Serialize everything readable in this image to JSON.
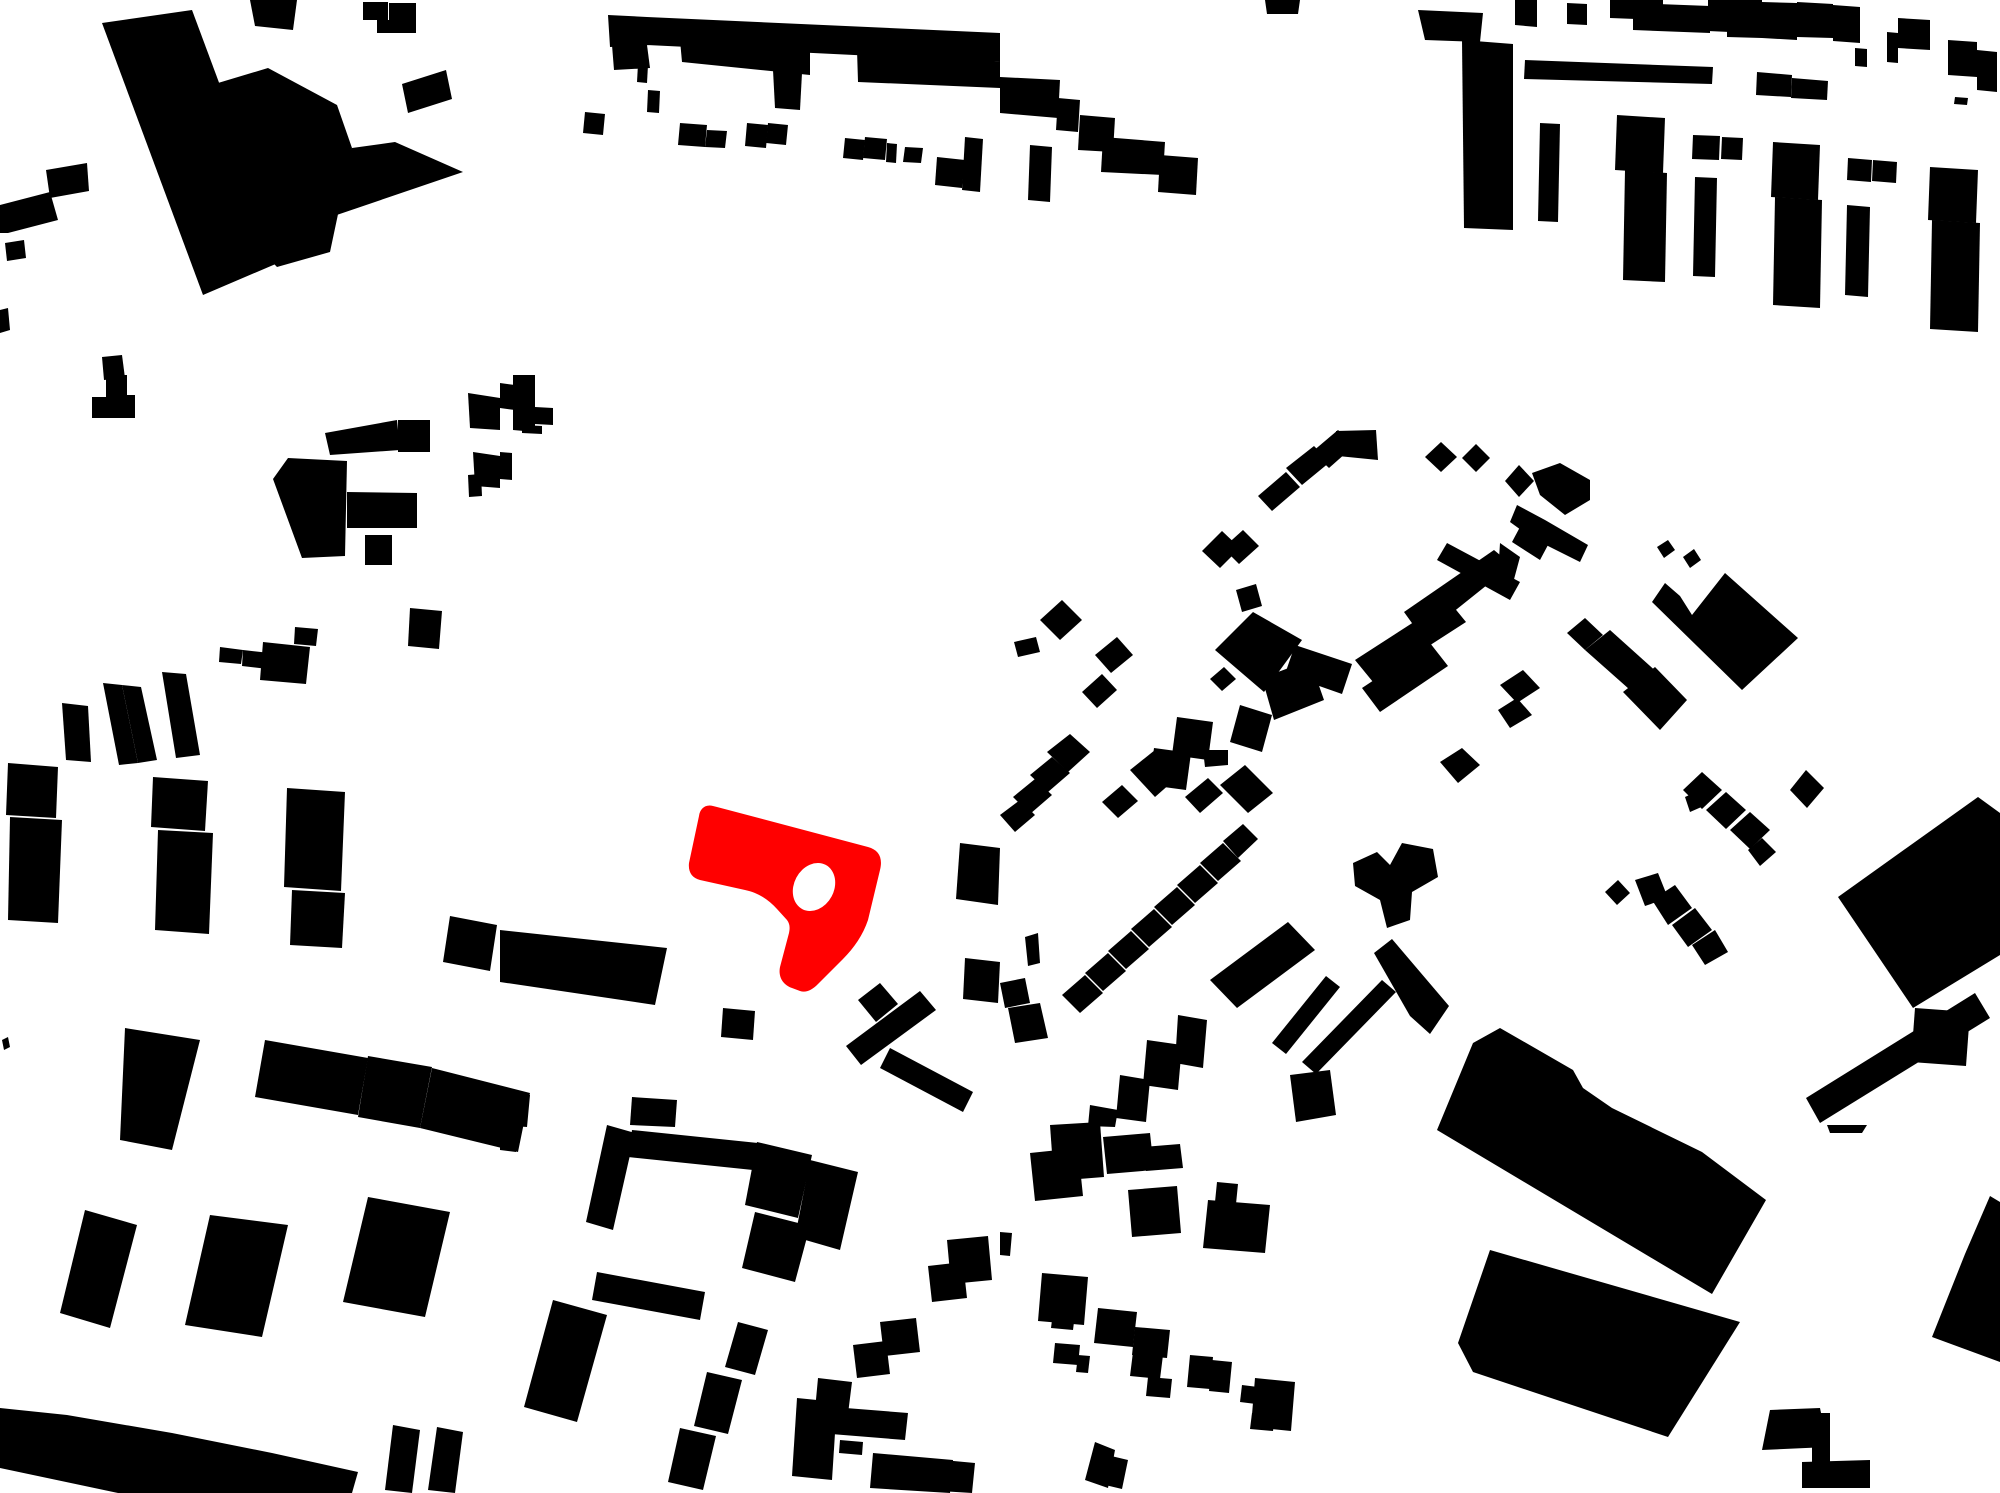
{
  "map": {
    "type": "figure-ground-site-plan",
    "canvas": {
      "width": 2000,
      "height": 1493,
      "viewBox": "0 0 2000 1493"
    },
    "colors": {
      "background": "#ffffff",
      "building": "#000000",
      "highlight": "#ff0000",
      "courtyard": "#ffffff"
    },
    "highlight": {
      "path": "M 713,806 C 705,804 700,809 699,816 L 689,863 C 688,872 692,878 700,880 L 745,890 C 759,893 769,900 777,909 L 787,920 C 790,924 790,928 789,933 L 780,967 C 778,977 783,985 792,988 L 800,991 C 806,993 812,990 818,984 L 843,959 C 854,948 863,935 868,920 L 880,870 C 883,858 879,850 868,847 L 717,807 Z",
      "courtyard_hole": {
        "cx": 814,
        "cy": 887,
        "rx": 20,
        "ry": 25,
        "rotation": 28
      }
    },
    "buildings": [
      "102,23 192,10 285,260 203,295",
      "218,83 268,68 337,105 352,148 330,252 277,267 232,220",
      "352,148 395,142 463,172 322,220",
      "250,0 297,0 293,30 255,26",
      "363,2 388,2 388,20 363,20",
      "389,3 416,3 416,33 389,33",
      "377,20 390,20 390,33 377,33",
      "402,84 446,70 452,99 408,113",
      "46,170 87,163 89,191 50,198",
      "0,205 50,192 58,220 8,233 0,233",
      "5,243 24,240 26,258 7,261",
      "0,310 8,308 10,330 0,333",
      "102,357 122,355 125,378 104,380",
      "608,15 647,17 650,45 610,47",
      "647,17 1000,33 1000,62 647,45",
      "612,45 647,45 650,68 614,70",
      "680,40 810,48 810,75 682,62",
      "857,50 1000,62 1000,88 858,82",
      "773,70 802,73 800,110 775,108",
      "638,64 648,65 647,83 637,82",
      "1000,77 1060,80 1058,118 1000,113",
      "1058,98 1080,100 1078,132 1056,130",
      "1080,115 1115,118 1113,152 1078,150",
      "1103,137 1165,142 1163,175 1101,172",
      "1160,155 1198,158 1196,195 1158,192",
      "1030,145 1052,147 1050,202 1028,200",
      "585,112 605,114 603,135 583,133",
      "648,90 660,91 659,113 647,112",
      "680,123 707,125 705,147 678,145",
      "707,130 727,131 725,148 705,147",
      "747,123 768,125 766,148 745,146",
      "768,123 788,125 786,145 766,143",
      "845,138 865,140 863,160 843,158",
      "865,137 887,139 885,160 863,158",
      "887,143 897,144 896,163 886,162",
      "905,147 923,148 921,163 903,162",
      "937,157 965,160 962,188 935,185",
      "965,137 983,139 980,192 962,190",
      "1265,0 1300,0 1298,14 1267,14",
      "1418,10 1483,13 1480,42 1425,40",
      "1462,40 1513,44 1513,230 1464,228",
      "1515,0 1537,0 1537,27 1515,25",
      "1567,3 1587,4 1587,25 1567,24",
      "1610,0 1663,0 1663,20 1610,18",
      "1633,3 1710,6 1710,33 1633,30",
      "1708,0 1730,0 1730,32 1708,31",
      "1727,0 1762,0 1762,38 1727,37",
      "1762,2 1797,3 1797,40 1762,38",
      "1797,2 1833,4 1833,38 1797,37",
      "1833,5 1860,7 1860,43 1833,41",
      "1887,32 1898,33 1898,63 1887,62",
      "1898,18 1930,20 1930,50 1898,48",
      "1948,40 1977,42 1977,77 1948,75",
      "1977,50 1997,52 1997,92 1977,90",
      "1855,48 1867,49 1867,67 1855,66",
      "1525,60 1713,67 1712,84 1524,79",
      "1757,72 1792,75 1791,97 1756,95",
      "1792,78 1828,81 1827,100 1791,98",
      "1955,97 1968,98 1967,105 1954,104",
      "1540,123 1560,124 1558,222 1538,221",
      "1617,115 1665,118 1663,173 1615,170",
      "1625,170 1667,173 1665,282 1623,280",
      "1693,135 1720,136 1719,160 1692,159",
      "1722,137 1743,138 1742,160 1721,159",
      "1695,177 1717,178 1715,277 1693,276",
      "1773,142 1820,145 1818,200 1771,197",
      "1775,197 1822,200 1820,308 1773,305",
      "1848,158 1872,160 1871,182 1847,180",
      "1873,160 1897,162 1896,183 1872,181",
      "1847,205 1870,207 1868,297 1845,295",
      "1930,167 1978,170 1976,223 1928,220",
      "1932,220 1980,223 1978,332 1930,329",
      "106,375 127,375 127,395 135,395 135,418 92,418 92,397 106,397",
      "325,433 397,420 400,450 330,455",
      "398,420 430,420 430,452 398,452",
      "288,458 347,461 345,556 302,558 273,479",
      "347,492 417,493 417,528 347,528",
      "365,535 392,535 392,565 365,565",
      "468,393 500,398 500,430 470,428",
      "473,452 500,456 500,488 475,486",
      "468,475 481,474 482,496 469,497",
      "220,647 243,650 241,664 219,662",
      "243,650 270,653 268,669 242,666",
      "263,642 310,647 306,684 260,680",
      "295,627 318,629 316,646 294,644",
      "410,608 442,611 439,649 408,646",
      "62,703 88,706 91,762 66,760",
      "103,683 122,685 138,763 119,765",
      "122,685 141,687 157,760 138,763",
      "162,672 186,674 200,755 176,758",
      "513,375 535,375 535,432 513,430",
      "500,383 515,385 515,410 500,408",
      "535,407 553,408 553,425 535,424",
      "522,425 542,426 542,434 522,433",
      "500,452 512,453 512,480 500,479",
      "1258,496 1286,472 1300,487 1272,511",
      "1286,468 1314,446 1330,462 1302,485",
      "1312,452 1338,430 1355,445 1329,468",
      "1336,431 1376,430 1378,460 1338,456",
      "1441,442 1457,457 1441,472 1425,457",
      "1476,444 1490,458 1476,472 1462,458",
      "1202,551 1222,531 1240,548 1220,568",
      "1223,548 1243,530 1259,546 1239,564",
      "1236,590 1256,584 1262,606 1242,612",
      "1215,650 1253,612 1302,640 1264,692",
      "1295,645 1352,664 1342,694 1285,674",
      "1262,678 1310,660 1324,700 1274,720",
      "1210,679 1224,667 1236,679 1222,691",
      "1240,705 1272,715 1262,752 1230,742",
      "1177,717 1213,722 1208,760 1172,755",
      "1154,748 1191,753 1186,790 1149,785",
      "1047,752 1070,734 1090,752 1068,772",
      "1030,775 1052,757 1070,773 1048,792",
      "1013,797 1035,779 1052,795 1030,814",
      "1000,815 1020,800 1035,815 1015,832",
      "1102,802 1122,785 1138,801 1118,818",
      "1130,770 1155,750 1180,775 1155,797",
      "1185,797 1208,778 1223,793 1200,813",
      "1220,785 1245,765 1273,793 1248,813",
      "1203,750 1228,750 1228,765 1205,767",
      "1040,620 1062,600 1082,620 1060,640",
      "1014,642 1036,637 1040,652 1018,657",
      "1095,655 1117,637 1133,655 1111,673",
      "1082,692 1102,674 1117,690 1097,708",
      "1353,863 1377,852 1390,865 1402,843 1433,849 1438,877 1412,892 1410,920 1387,928 1380,900 1355,886",
      "960,843 1000,848 998,905 956,899",
      "965,958 1000,962 998,1003 963,999",
      "1000,983 1025,978 1030,1003 1005,1008",
      "1008,1008 1040,1003 1048,1038 1015,1043",
      "1025,937 1038,933 1040,963 1028,966",
      "1062,995 1085,975 1103,993 1080,1013",
      "1085,973 1108,953 1126,971 1103,991",
      "1108,951 1131,931 1149,949 1126,969",
      "1131,929 1154,909 1172,927 1149,947",
      "1154,907 1177,887 1195,905 1172,925",
      "1177,885 1200,865 1218,883 1195,903",
      "1200,863 1223,843 1241,861 1218,881",
      "1223,841 1243,824 1258,839 1238,858",
      "1210,980 1288,922 1315,950 1237,1008",
      "1272,1043 1326,976 1340,987 1286,1054",
      "1302,1062 1382,980 1396,992 1316,1074",
      "1374,953 1392,939 1449,1006 1430,1034 1410,1016",
      "1290,1075 1330,1070 1336,1115 1296,1122",
      "1178,1015 1207,1020 1203,1068 1175,1063",
      "1147,1040 1182,1045 1178,1090 1143,1085",
      "1120,1075 1150,1080 1146,1122 1116,1118",
      "1090,1105 1118,1110 1115,1127 1088,1126",
      "1440,762 1462,748 1480,765 1458,783",
      "1404,612 1494,550 1512,565 1422,637",
      "1447,543 1520,582 1510,600 1437,560",
      "1355,660 1448,600 1466,622 1373,682",
      "1362,688 1430,643 1448,666 1380,712",
      "1505,481 1519,465 1534,481 1519,497",
      "1532,473 1560,463 1590,480 1590,500 1565,515 1540,495",
      "1517,505 1545,520 1588,545 1580,562 1532,538 1510,522",
      "1520,527 1548,545 1540,560 1512,542",
      "1500,543 1520,557 1513,583 1498,575",
      "1657,547 1668,540 1675,550 1664,558",
      "1683,557 1694,549 1701,560 1690,568",
      "1652,602 1665,583 1680,596 1692,615 1725,573 1798,638 1742,690",
      "1567,633 1585,618 1603,635 1585,650",
      "1585,650 1610,630 1660,675 1638,697",
      "1623,692 1655,667 1687,700 1660,730",
      "1500,685 1523,670 1540,688 1517,703",
      "1498,710 1517,698 1532,715 1510,728",
      "1683,790 1702,772 1722,790 1702,809",
      "1706,810 1726,792 1746,810 1726,829",
      "1730,830 1750,812 1770,830 1750,849",
      "1748,850 1762,838 1776,852 1760,866",
      "1685,797 1700,790 1706,805 1690,812",
      "1790,790 1806,770 1824,788 1807,808",
      "1605,892 1618,880 1630,893 1617,905",
      "1635,880 1658,873 1668,898 1645,906",
      "1652,900 1675,885 1692,908 1668,925",
      "1672,925 1695,908 1712,930 1688,947",
      "1692,945 1715,930 1728,952 1705,965",
      "1978,797 2000,813 2000,955 1913,1008 1838,897",
      "1806,1098 1975,993 1990,1018 1820,1123",
      "1915,1008 1970,1012 1966,1066 1911,1062",
      "500,930 667,948 655,1005 500,982",
      "723,1008 755,1011 753,1040 721,1037",
      "846,1046 920,991 936,1010 861,1065",
      "858,1000 880,983 898,1004 876,1022",
      "890,1048 973,1092 963,1112 880,1068",
      "500,1093 530,1095 527,1127 500,1125",
      "632,1097 677,1100 675,1127 630,1125",
      "8,763 58,767 56,818 6,815",
      "10,817 62,820 58,923 8,920",
      "153,777 208,781 205,831 151,827",
      "158,830 213,833 209,934 155,930",
      "287,788 345,792 341,891 284,887",
      "292,890 345,893 342,948 290,945",
      "450,916 497,925 490,971 443,962",
      "125,1028 200,1040 172,1150 120,1140",
      "265,1040 368,1058 358,1115 255,1097",
      "368,1056 432,1067 420,1128 358,1117",
      "432,1068 530,1093 518,1152 420,1128",
      "2,1040 8,1037 10,1047 4,1050",
      "85,1210 137,1225 110,1328 60,1313",
      "210,1215 288,1225 262,1337 185,1325",
      "368,1197 450,1212 425,1317 343,1302",
      "0,1408 67,1415 172,1433 272,1453 358,1472 352,1493 118,1493 0,1468",
      "393,1425 420,1430 412,1493 385,1490",
      "437,1427 463,1432 455,1493 428,1490",
      "607,1125 635,1133 613,1230 586,1222",
      "632,1130 758,1143 753,1170 628,1157",
      "757,1142 812,1155 798,1218 745,1205",
      "810,1160 858,1172 840,1250 795,1237",
      "755,1212 810,1226 795,1282 742,1268",
      "597,1272 705,1292 700,1320 592,1300",
      "553,1300 607,1315 577,1422 524,1407",
      "738,1322 768,1330 755,1375 725,1367",
      "707,1372 742,1380 728,1434 694,1426",
      "680,1428 716,1436 703,1490 668,1482",
      "818,1378 852,1382 848,1414 815,1410",
      "797,1398 837,1402 832,1480 792,1476",
      "833,1407 908,1413 905,1440 831,1434",
      "840,1440 863,1442 862,1455 839,1453",
      "873,1453 953,1460 950,1493 870,1488",
      "943,1460 975,1463 972,1493 940,1491",
      "853,1345 886,1341 890,1374 857,1378",
      "880,1322 916,1318 920,1352 884,1356",
      "928,1266 963,1262 967,1298 932,1302",
      "947,1240 988,1236 992,1280 951,1284",
      "500,1125 520,1127 516,1152 500,1150",
      "1030,1153 1078,1148 1083,1196 1035,1201",
      "1050,1125 1100,1122 1104,1177 1054,1181",
      "1103,1137 1150,1133 1154,1170 1107,1174",
      "1128,1190 1177,1186 1181,1233 1132,1237",
      "1143,1147 1180,1144 1183,1168 1146,1171",
      "1208,1200 1270,1205 1265,1253 1203,1248",
      "1217,1182 1238,1184 1236,1204 1215,1202",
      "1000,1232 1012,1233 1010,1256 1000,1255",
      "1042,1273 1088,1277 1084,1325 1038,1321",
      "1053,1312 1075,1314 1073,1330 1051,1328",
      "1055,1343 1080,1345 1078,1365 1053,1363",
      "1078,1355 1090,1356 1088,1373 1076,1372",
      "1098,1308 1137,1312 1133,1347 1094,1343",
      "1135,1327 1170,1330 1167,1358 1132,1355",
      "1133,1352 1163,1355 1160,1379 1130,1376",
      "1148,1377 1172,1379 1170,1398 1146,1396",
      "1190,1355 1213,1357 1210,1389 1187,1387",
      "1212,1360 1232,1362 1229,1393 1209,1391",
      "1255,1378 1295,1382 1291,1431 1251,1427",
      "1242,1385 1258,1387 1256,1404 1240,1402",
      "1252,1413 1275,1415 1273,1431 1250,1429",
      "1095,1442 1115,1450 1108,1488 1085,1480",
      "1107,1455 1128,1460 1122,1489 1101,1484",
      "1473,1043 1500,1028 1573,1070 1583,1088 1612,1108 1702,1152 1766,1200 1712,1294 1437,1130",
      "1490,1250 1740,1322 1668,1437 1473,1372 1458,1343",
      "1990,1196 2000,1202 2000,1362 1932,1337 1965,1254",
      "1770,1410 1820,1408 1828,1447 1762,1450",
      "1812,1413 1830,1413 1830,1488 1812,1488",
      "1802,1462 1870,1460 1870,1488 1802,1488",
      "1827,1125 1867,1125 1862,1133 1830,1133"
    ]
  }
}
